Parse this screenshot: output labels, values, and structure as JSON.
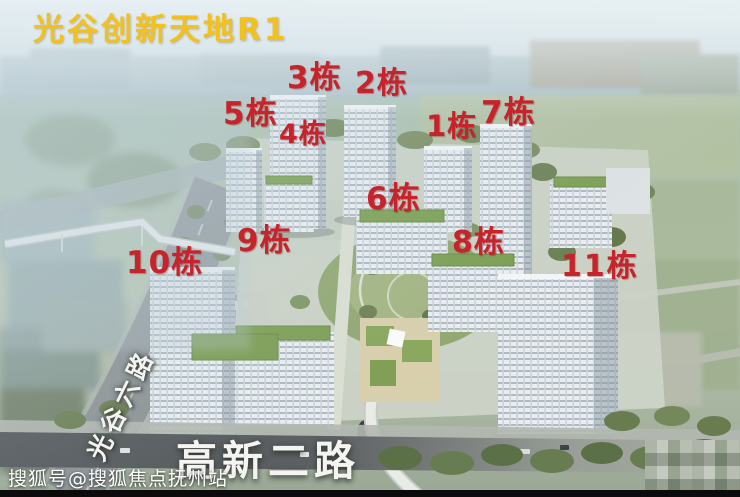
{
  "title": "光谷创新天地R1",
  "building_labels": {
    "b1": "1栋",
    "b2": "2栋",
    "b3": "3栋",
    "b4": "4栋",
    "b5": "5栋",
    "b6": "6栋",
    "b7": "7栋",
    "b8": "8栋",
    "b9": "9栋",
    "b10": "10栋",
    "b11": "11栋"
  },
  "roads": {
    "vertical_road": "光谷六路",
    "horizontal_road": "高新二路"
  },
  "watermark": "搜狐号@搜狐焦点抚州站",
  "colors": {
    "title_text": "#f2c11d",
    "building_label_text": "#c7232b",
    "road_label_text": "#f4f4f1",
    "green_roof": "#7da055",
    "sky_haze": "#cfe0e6"
  }
}
